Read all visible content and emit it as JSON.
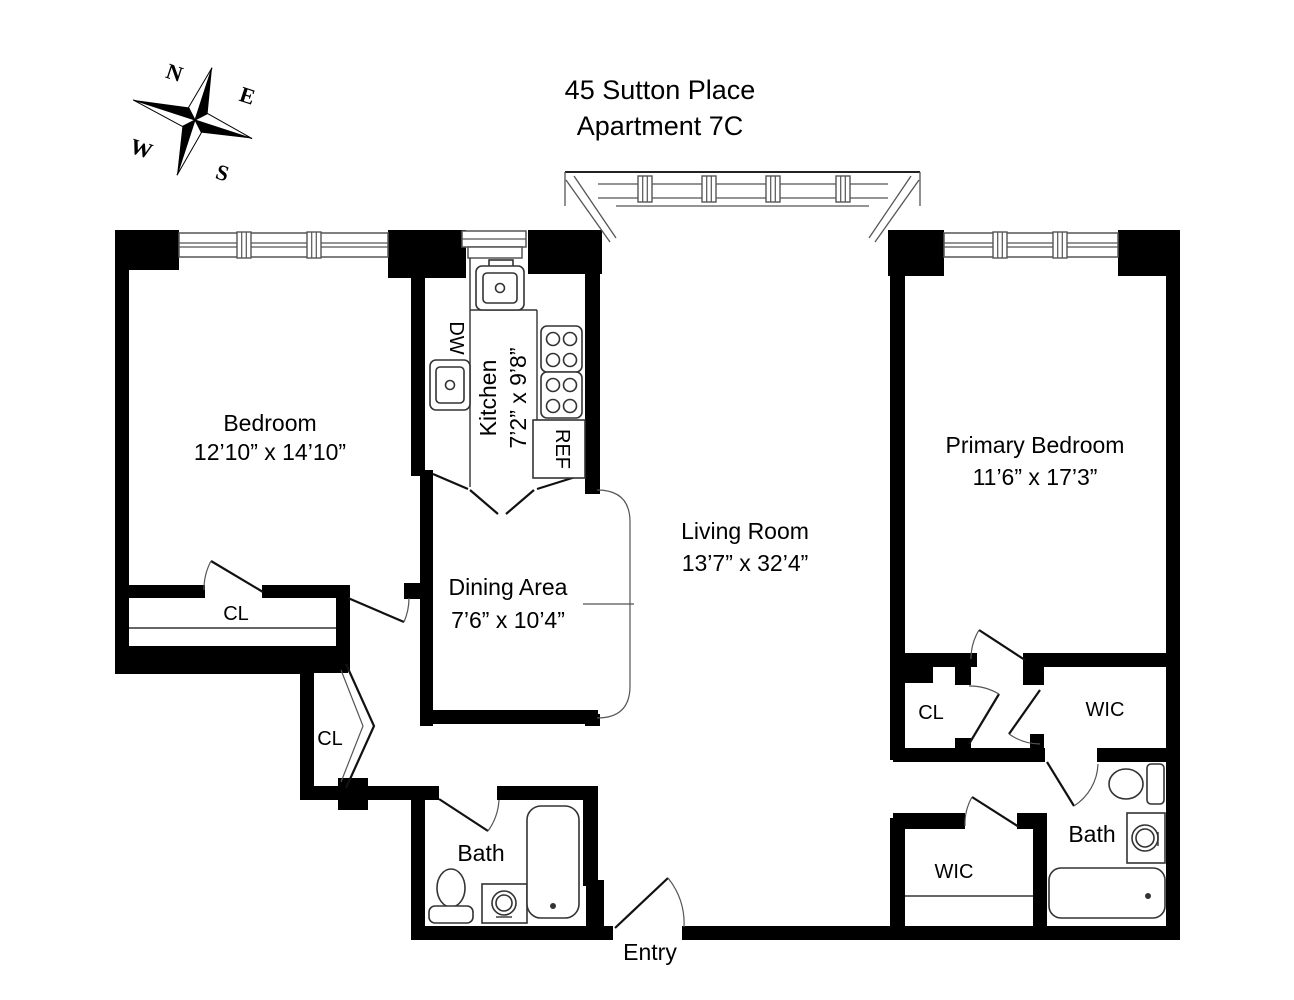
{
  "title": {
    "line1": "45 Sutton Place",
    "line2": "Apartment 7C"
  },
  "compass": {
    "n": "N",
    "e": "E",
    "w": "W",
    "s": "S"
  },
  "rooms": {
    "bedroom": {
      "name": "Bedroom",
      "dims": "12’10” x 14’10”"
    },
    "kitchen": {
      "name": "Kitchen",
      "dims": "7’2” x 9’8”"
    },
    "dining": {
      "name": "Dining Area",
      "dims": "7’6” x 10’4”"
    },
    "living": {
      "name": "Living Room",
      "dims": "13’7” x 32’4”"
    },
    "primary": {
      "name": "Primary Bedroom",
      "dims": "11’6” x 17’3”"
    }
  },
  "labels": {
    "closet1": "CL",
    "closet2": "CL",
    "closet3": "CL",
    "wic1": "WIC",
    "wic2": "WIC",
    "bath1": "Bath",
    "bath2": "Bath",
    "entry": "Entry",
    "dishwasher": "DW",
    "refrigerator": "REF"
  },
  "colors": {
    "wall": "#000000",
    "fixture": "#333333",
    "window": "#555555"
  }
}
